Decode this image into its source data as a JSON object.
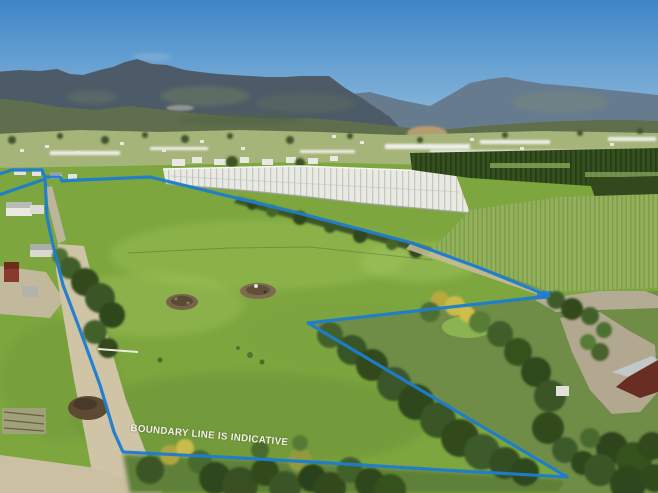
{
  "overlay": {
    "boundary_label": "BOUNDARY LINE IS INDICATIVE",
    "boundary_color": "#1d7dce",
    "label_color": "#f2f2ea"
  },
  "scene": {
    "sky_top": "#3e86c7",
    "sky_horizon": "#bdd6e8",
    "mountain_far": "#667b8e",
    "mountain_near": "#4c5b67",
    "mountain_patch": "#6d7c64",
    "foothills": "#5f6f4d",
    "bare_hill": "#b59c70",
    "valley": "#a5b478",
    "netting_white": "#e9eae4",
    "orchard_dark": "#35501f",
    "crop_rows": "#93b15a",
    "pasture": "#7da63f",
    "pasture_light": "#9cc257",
    "pasture_shadow": "#6d9138",
    "driveway_tan": "#cfc4a6",
    "gravel_grey": "#b4ab94",
    "tree_dark": "#33491f",
    "tree_mid": "#42612c",
    "gorse_yellow": "#c9bc4a",
    "barn_red": "#8a3a2c",
    "roof_silver": "#c2c7c9",
    "roof_red": "#6a2d24",
    "building_white": "#e9e9e2"
  }
}
